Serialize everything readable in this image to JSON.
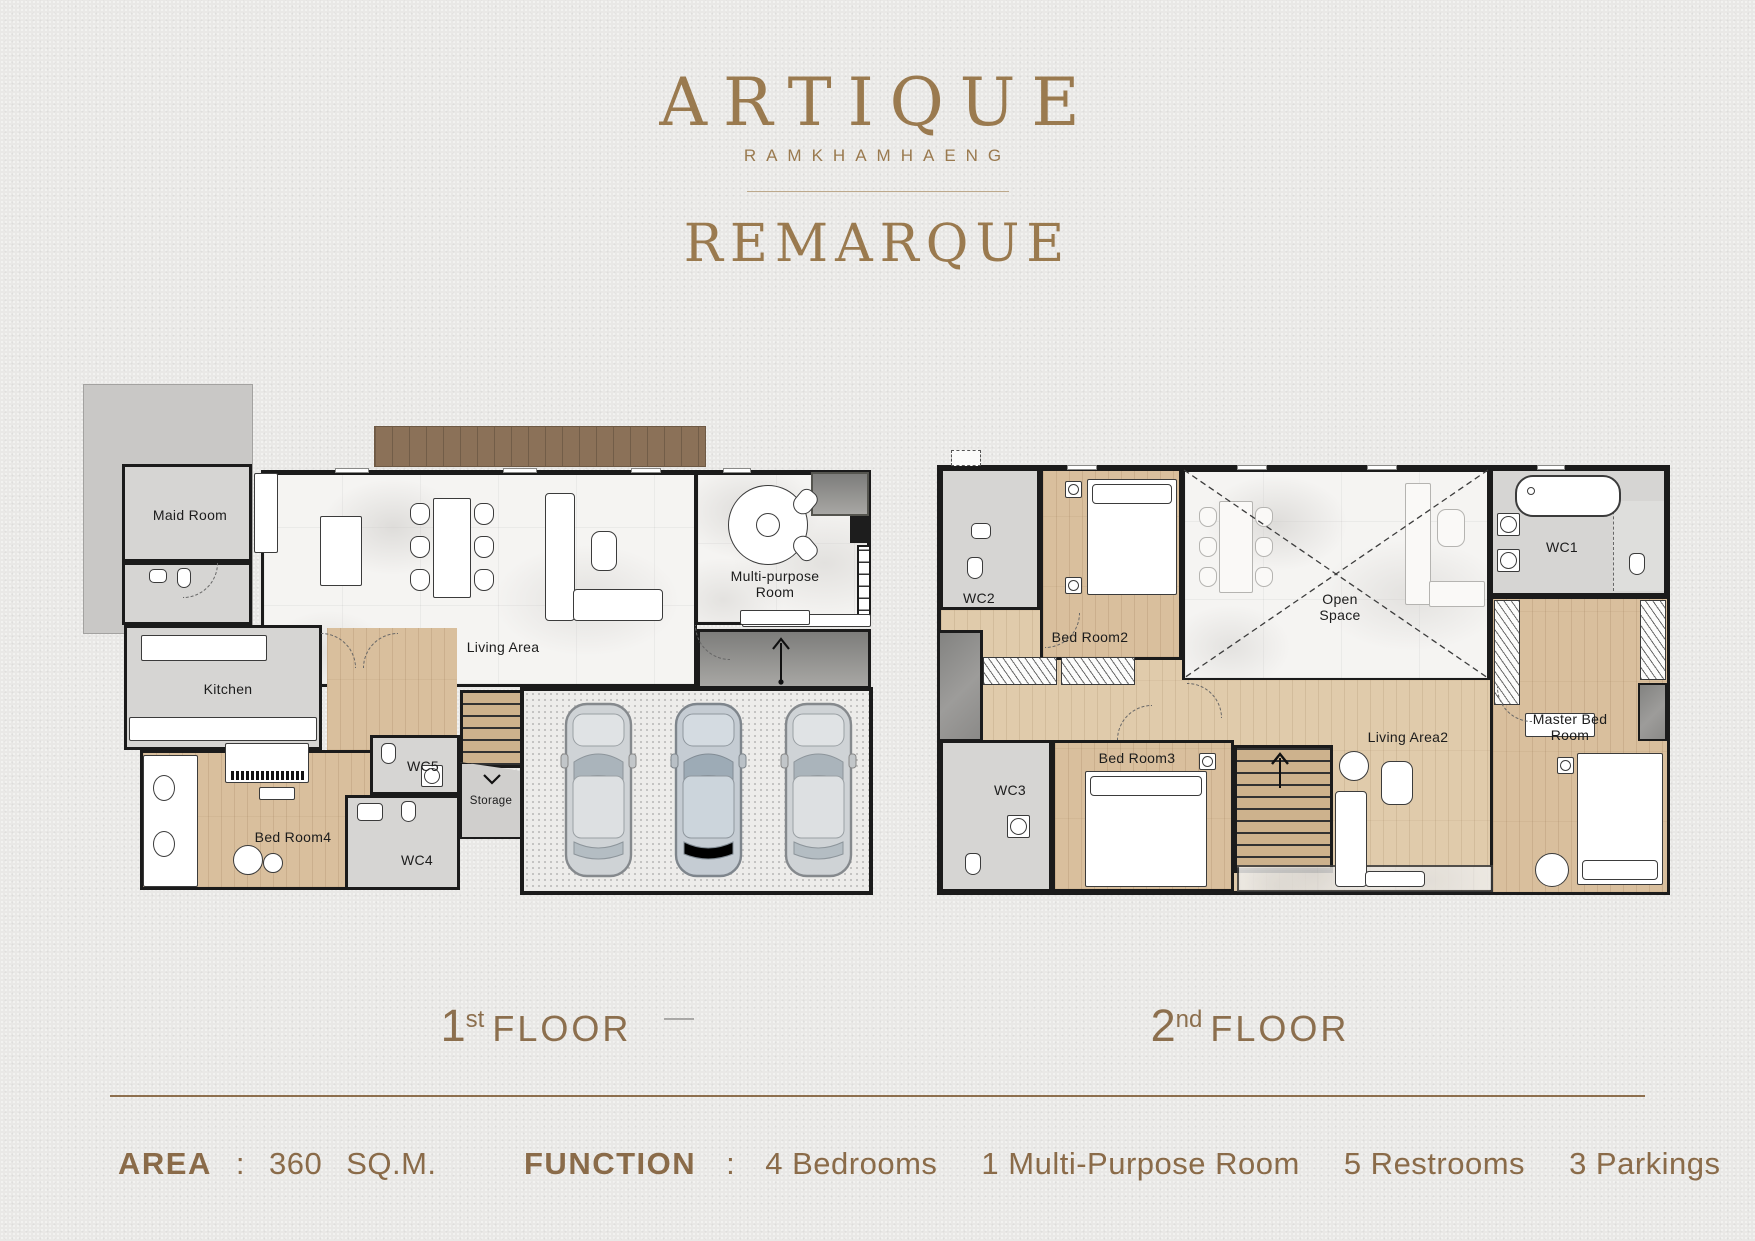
{
  "header": {
    "brand": "ARTIQUE",
    "location": "RAMKHAMHAENG",
    "plan_name": "REMARQUE"
  },
  "floor1": {
    "label": {
      "number": "1",
      "suffix": "st",
      "word": "FLOOR"
    },
    "rooms": {
      "maid_room": "Maid Room",
      "kitchen": "Kitchen",
      "living_area": "Living Area",
      "multi_purpose_room": "Multi-purpose Room",
      "wc5": "WC5",
      "wc4": "WC4",
      "storage": "Storage",
      "bed_room4": "Bed Room4"
    }
  },
  "floor2": {
    "label": {
      "number": "2",
      "suffix": "nd",
      "word": "FLOOR"
    },
    "rooms": {
      "wc2": "WC2",
      "bed_room2": "Bed Room2",
      "open_space": "Open\nSpace",
      "wc1": "WC1",
      "wc3": "WC3",
      "bed_room3": "Bed Room3",
      "living_area2": "Living Area2",
      "master_bed_room": "Master Bed Room"
    }
  },
  "footer": {
    "area_label": "AREA",
    "colon": ":",
    "area_value": "360",
    "area_unit": "SQ.M.",
    "function_label": "FUNCTION",
    "functions": [
      "4 Bedrooms",
      "1 Multi-Purpose Room",
      "5 Restrooms",
      "3 Parkings"
    ]
  },
  "colors": {
    "accent_gold": "#9a7a4f",
    "text_brown": "#8a6b49",
    "wall": "#1b1b1b",
    "wood_floor": "#d9bf9d",
    "gray_floor": "#d6d5d3",
    "marble_floor": "#f5f4f2",
    "deck_brown": "#8b7158"
  }
}
